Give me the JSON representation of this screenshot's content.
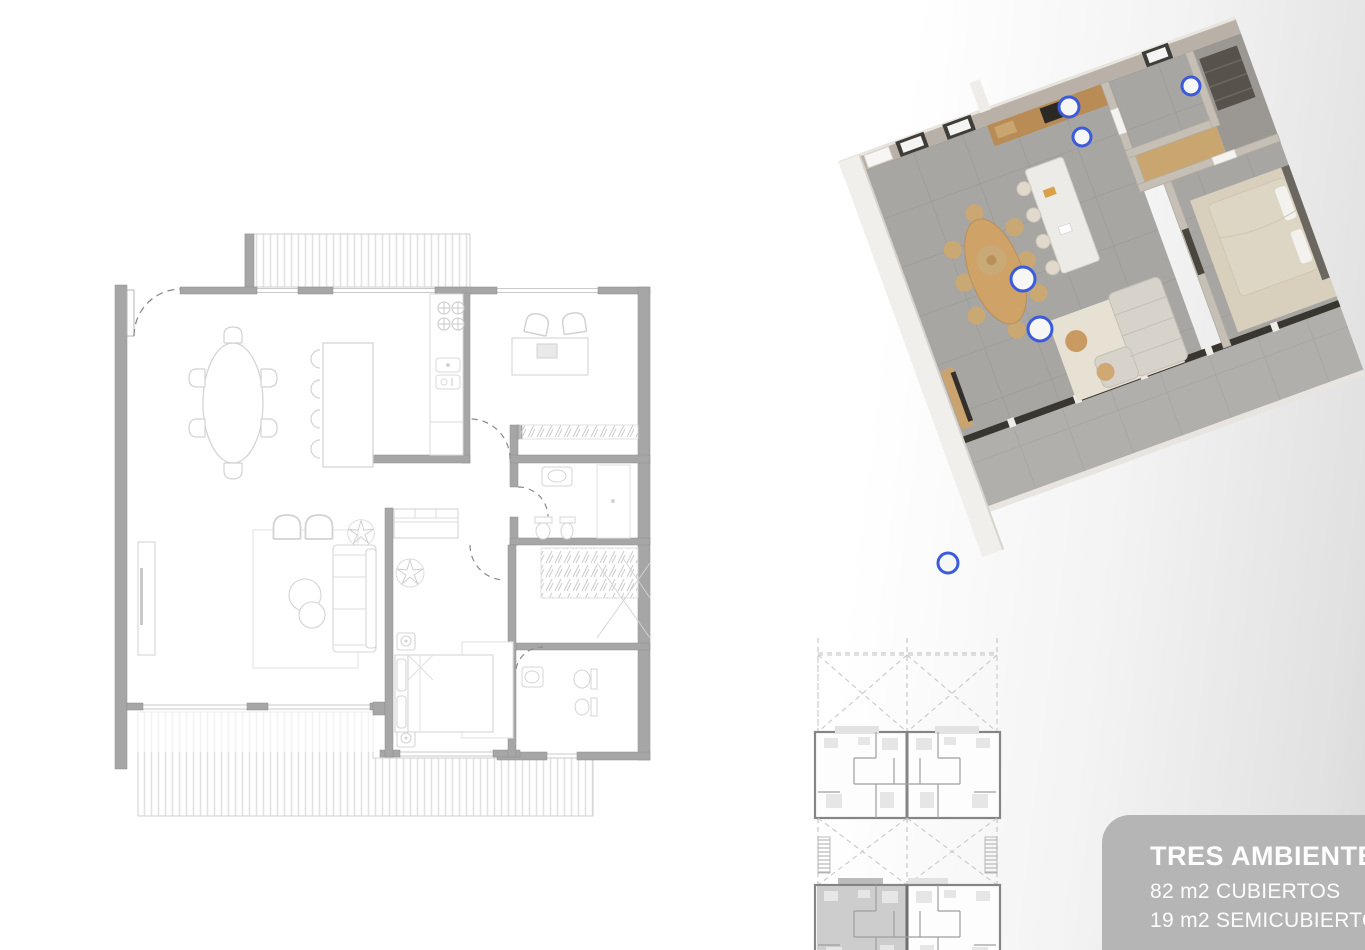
{
  "info_card": {
    "title": "TRES AMBIENTES",
    "area_line_1": "82 m2 CUBIERTOS",
    "area_line_2": "19 m2 SEMICUBIERTOS",
    "background": "#b5b5b5",
    "text_color": "#fdfdfd"
  },
  "palette": {
    "page_bg_left": "#ffffff",
    "page_bg_right": "#d9d9d9",
    "plan_wall_gray": "#a6a6a6",
    "plan_furniture_line": "#d2d2d2",
    "plan_deck_hatch": "#e2e2e2",
    "plan_door_arc": "#8a8a8a",
    "keyplan_wall": "#858585",
    "keyplan_dashed": "#bdbdbd",
    "keyplan_unit_highlight": "#c4c4c4",
    "render_floor_tile": "#a8a6a3",
    "render_terrace_tile": "#b1afac",
    "render_wall_beige": "#b9b1a7",
    "render_wall_white": "#f1efec",
    "render_wood": "#cfa268",
    "render_rug": "#e8e2d4",
    "render_window_frame": "#3f3d39",
    "ceiling_light_ring_blue": "#3b5bdb"
  }
}
